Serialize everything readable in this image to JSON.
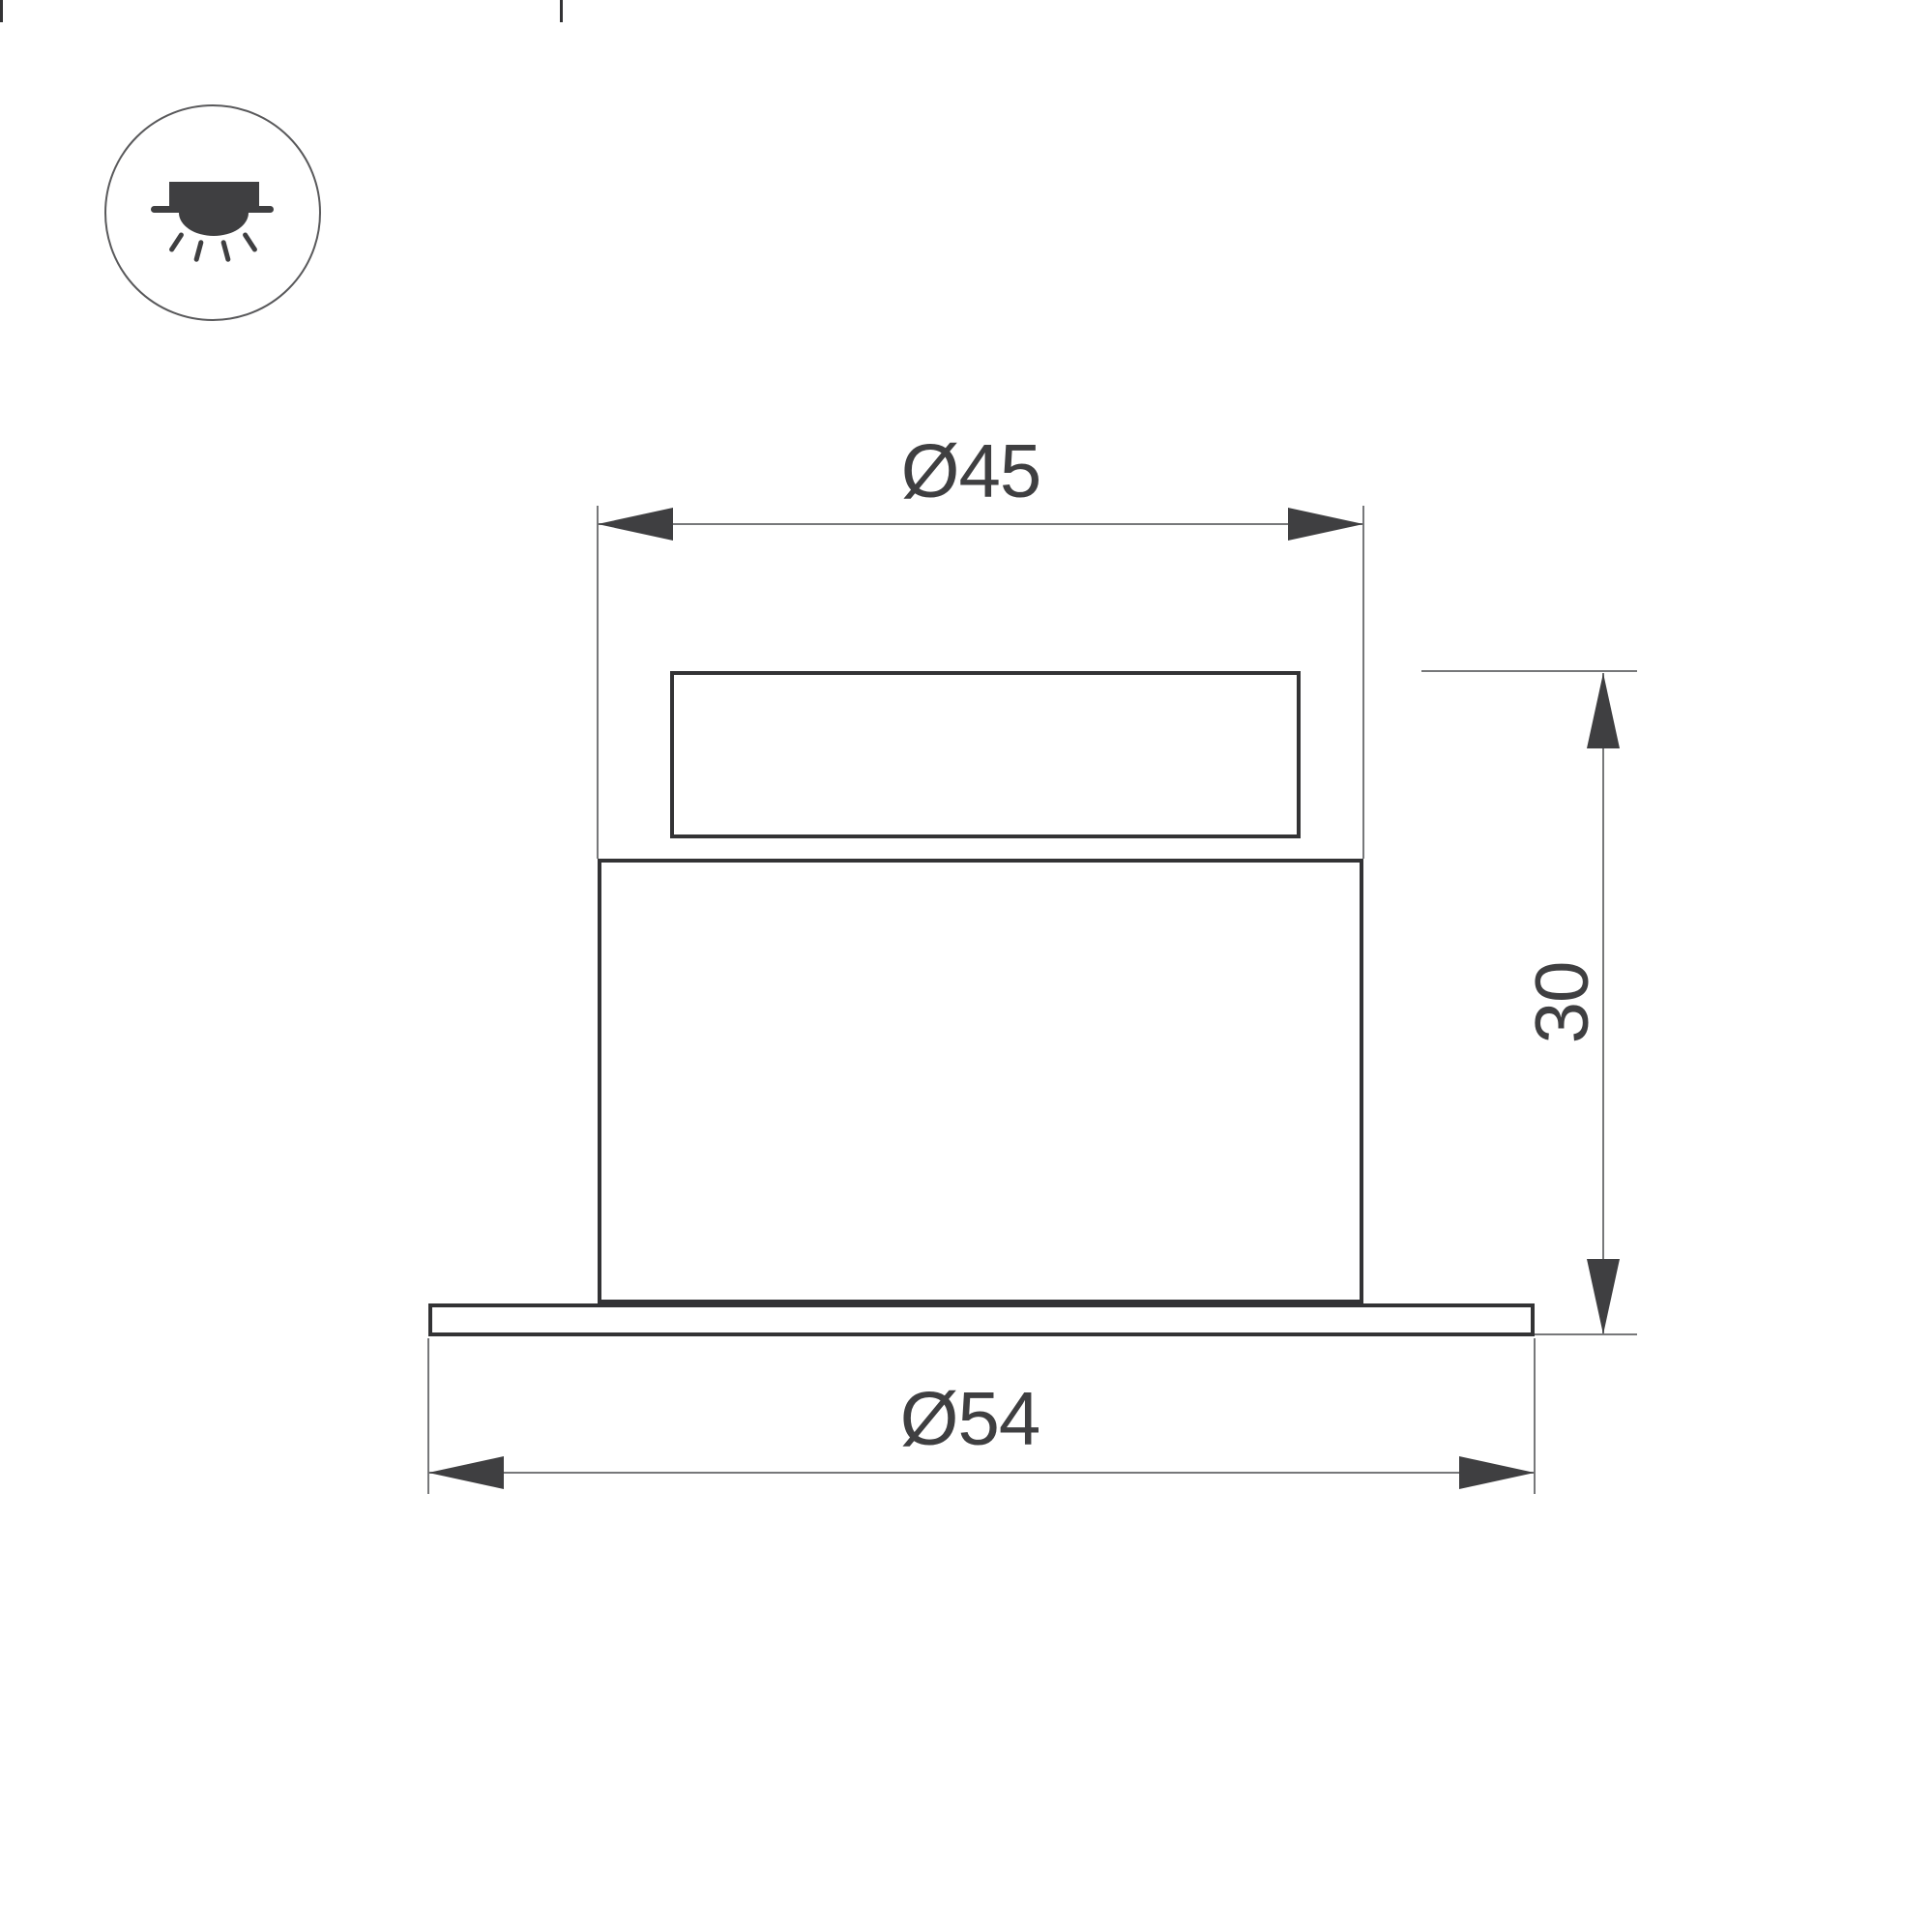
{
  "drawing": {
    "icon": {
      "type": "recessed-downlight"
    },
    "labels": {
      "diameter_top": "Ø45",
      "diameter_bottom": "Ø54",
      "height": "30"
    },
    "colors": {
      "background": "#ffffff",
      "outline": "#333335",
      "dimension_line": "#77787a",
      "arrow_and_text": "#3f3f41",
      "icon_circle_stroke": "#59595b"
    }
  }
}
